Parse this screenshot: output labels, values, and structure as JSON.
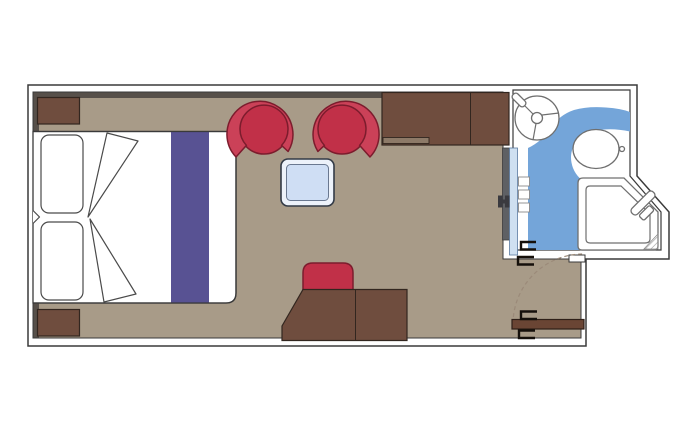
{
  "title": "cabin-floor-plan",
  "colors": {
    "wallLine": "#3a3a3a",
    "floor": "#a89b88",
    "shadow": "#57504a",
    "wood": "#6f4d3e",
    "woodSeam": "#32261f",
    "woodLip": "#8d7a68",
    "doorWood": "#6a4534",
    "red": "#c13048",
    "redBand": "#cb4158",
    "redOutline": "#7c1c2d",
    "purple": "#585293",
    "tableOuterFill": "#edf2fa",
    "tableInnerFill": "#cfdef4",
    "tableStroke": "#323a46",
    "bathBlue": "#74a5d9",
    "fixtureStroke": "#6f6f6f",
    "pocketGray": "#5e6064",
    "pocketBlue": "#cfe0f1",
    "pocketBlueStroke": "#5b7aa0",
    "handleBlack": "#15100b",
    "arcDash": "#9b8a79",
    "slatStroke": "#8a8a8a",
    "hatch": "#999999"
  },
  "rooms": [
    {
      "name": "cabin",
      "floor_color": "#a89b88"
    },
    {
      "name": "bathroom",
      "floor_color": "#74a5d9"
    }
  ],
  "furniture": [
    "double-bed",
    "pillow-left-top",
    "pillow-left-bottom",
    "folded-blanket-top",
    "folded-blanket-bottom",
    "bed-runner",
    "nightstand-top",
    "nightstand-bottom",
    "armchair-left",
    "armchair-right",
    "coffee-table",
    "wardrobe",
    "desk",
    "stool",
    "entry-door",
    "bathroom-sliding-door",
    "washbasin",
    "toilet",
    "shower"
  ]
}
